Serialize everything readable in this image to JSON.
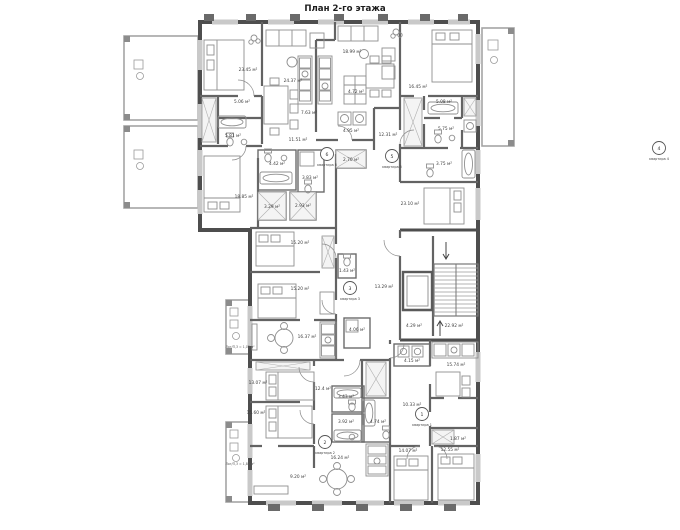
{
  "title": "План 2-го этажа",
  "floor_plan": {
    "apartments": {
      "apt1": {
        "number": "1",
        "label": "квартира 1"
      },
      "apt2": {
        "number": "2",
        "label": "квартира 2"
      },
      "apt3": {
        "number": "3",
        "label": "квартира 3"
      },
      "apt4": {
        "number": "4",
        "label": "квартира 4"
      },
      "apt5": {
        "number": "5",
        "label": "квартира 5"
      },
      "apt6": {
        "number": "6",
        "label": "квартира 6"
      }
    },
    "rooms": {
      "apt6_bedroom1": "23.45 м²",
      "apt6_living_room": "24.37 м²",
      "apt6_wardrobe": "5.06 м²",
      "apt6_bathroom": "5.81 м²",
      "apt6_kitchen": "7.63 м²",
      "apt6_hall": "11.51 м²",
      "apt6_bedroom2": "18.85 м²",
      "apt6_bathroom2": "4.42 м²",
      "apt6_wc": "3.83 м²",
      "apt6_storage1": "3.29 м²",
      "apt6_storage2": "2.93 м²",
      "apt5_living_room": "18.99 м²",
      "apt5_pantry": "4.72 м²",
      "apt5_laundry": "4.95 м²",
      "apt5_storage": "2.70 м²",
      "apt5_hall": "12.31 м²",
      "apt5_bathroom": "3.75 м²",
      "apt5_bedroom": "23.10 м²",
      "apt4_bedroom": "16.45 м²",
      "apt4_hall": "5.08 м²",
      "apt4_bathroom": "5.75 м²",
      "apt3_bedroom1": "15.20 м²",
      "apt3_bedroom2": "15.20 м²",
      "apt3_wc": "1.43 м²",
      "apt3_living_room": "16.37 м²",
      "apt3_bathroom": "4.06 м²",
      "corridor": "13.29 м²",
      "apt2_bedroom1": "13.07 м²",
      "apt2_bedroom2": "15.60 м²",
      "apt2_hall": "12.4 м²",
      "apt2_bathroom1": "3.43 м²",
      "apt2_bathroom2": "3.92 м²",
      "apt2_living_room": "9.20 м²",
      "apt2_kitchen": "16.24 м²",
      "apt1_bathroom": "4.74 м²",
      "apt1_pantry": "4.15 м²",
      "apt1_kitchen": "15.74 м²",
      "apt1_hall": "10.33 м²",
      "apt1_wardrobe": "1.87 м²",
      "apt1_bedroom1": "14.07 м²",
      "apt1_bedroom2": "12.55 м²",
      "lift_lobby": "4.29 м²",
      "stairwell": "22.92 м²"
    },
    "balconies": {
      "apt3_note": "Лог/П,3 = 1,03 м²",
      "apt2_note": "Лог/П,3 = 1,82 м²"
    }
  }
}
